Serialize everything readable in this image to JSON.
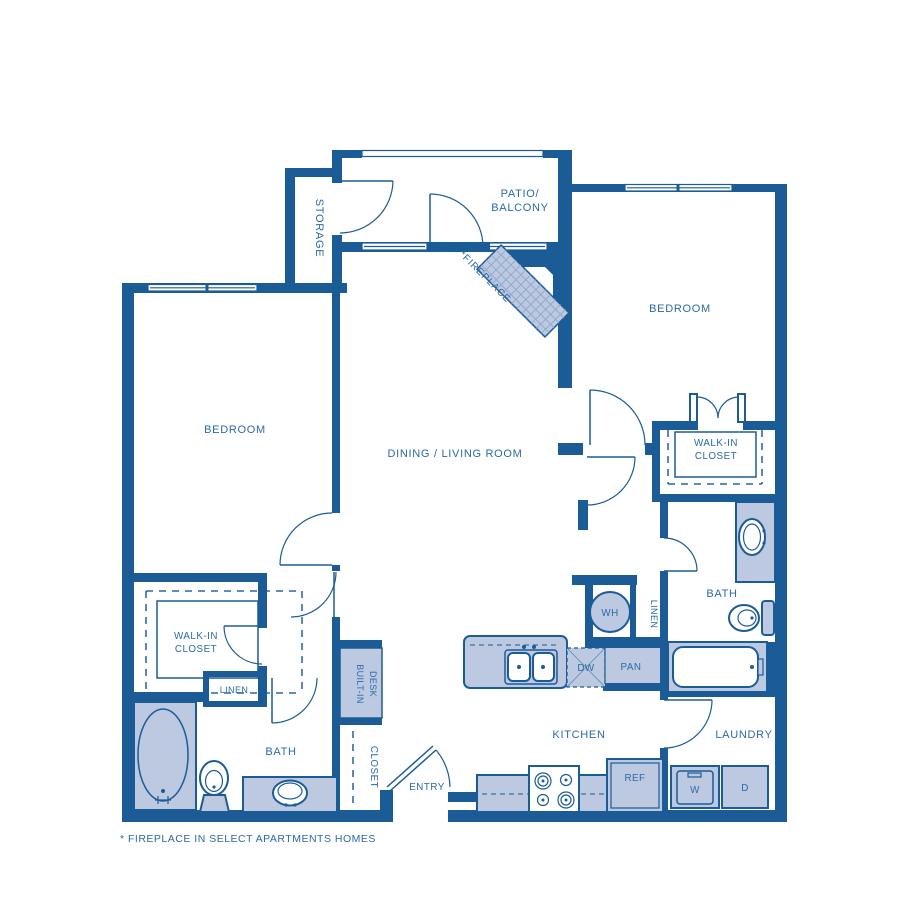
{
  "colors": {
    "wall": "#1b5c97",
    "fixture": "#bdc9e0",
    "label": "#2a6aa8",
    "hatch": "#8fa6cc",
    "white": "#ffffff"
  },
  "labels": {
    "storage": "STORAGE",
    "patio_line1": "PATIO/",
    "patio_line2": "BALCONY",
    "fireplace": "*FIREPLACE",
    "bedroom_left": "BEDROOM",
    "bedroom_right": "BEDROOM",
    "dining": "DINING / LIVING ROOM",
    "walkin_left_line1": "WALK-IN",
    "walkin_left_line2": "CLOSET",
    "walkin_right_line1": "WALK-IN",
    "walkin_right_line2": "CLOSET",
    "linen_left": "LINEN",
    "linen_right": "LINEN",
    "bath_left": "BATH",
    "bath_right": "BATH",
    "wh": "WH",
    "dw": "DW",
    "pan": "PAN",
    "kitchen": "KITCHEN",
    "laundry": "LAUNDRY",
    "ref": "REF",
    "washer": "W",
    "dryer": "D",
    "builtin_line1": "BUILT-IN",
    "builtin_line2": "DESK",
    "entry_closet": "CLOSET",
    "entry": "ENTRY",
    "footnote": "* FIREPLACE IN SELECT APARTMENTS HOMES"
  }
}
